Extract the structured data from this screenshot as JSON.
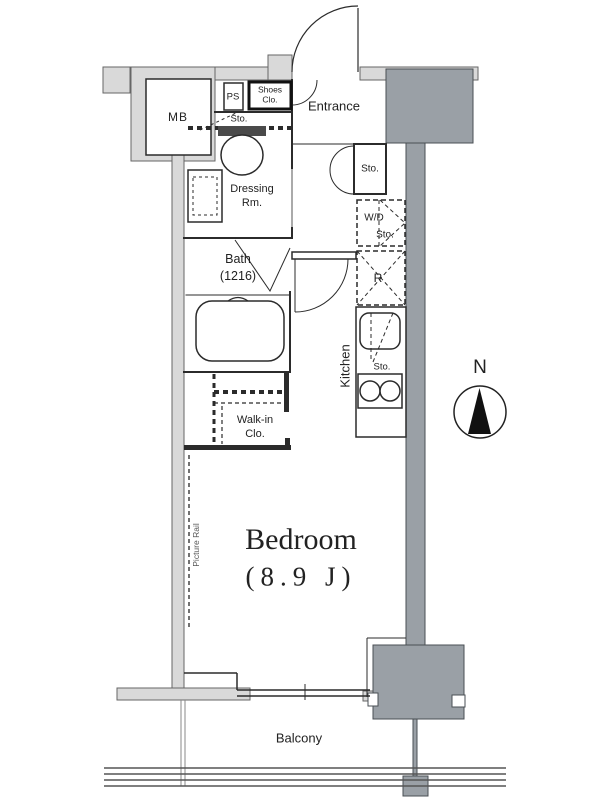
{
  "colors": {
    "wall-fill": "#d9d9d9",
    "wall-stroke": "#666666",
    "column-fill": "#9aa0a6",
    "column-stroke": "#4a4f54",
    "line": "#2b2b2b",
    "text": "#222222"
  },
  "plan": {
    "mb_label": "MB",
    "ps_label": "PS",
    "shoes_closet_line1": "Shoes",
    "shoes_closet_line2": "Clo.",
    "entrance_label": "Entrance",
    "entrance_storage_label": "Sto.",
    "toilet_storage_label": "Sto.",
    "dressing_room_line1": "Dressing",
    "dressing_room_line2": "Rm.",
    "washer_dryer_line1": "W/D",
    "washer_dryer_line2": "Sto.",
    "refrigerator_label": "R",
    "bath_line1": "Bath",
    "bath_line2": "(1216)",
    "kitchen_label": "Kitchen",
    "kitchen_storage_label": "Sto.",
    "walkin_closet_line1": "Walk-in",
    "walkin_closet_line2": "Clo.",
    "bedroom_name": "Bedroom",
    "bedroom_size": "(8.9 J)",
    "picture_rail_label": "Picture Rail",
    "balcony_label": "Balcony",
    "compass_north_label": "N"
  }
}
